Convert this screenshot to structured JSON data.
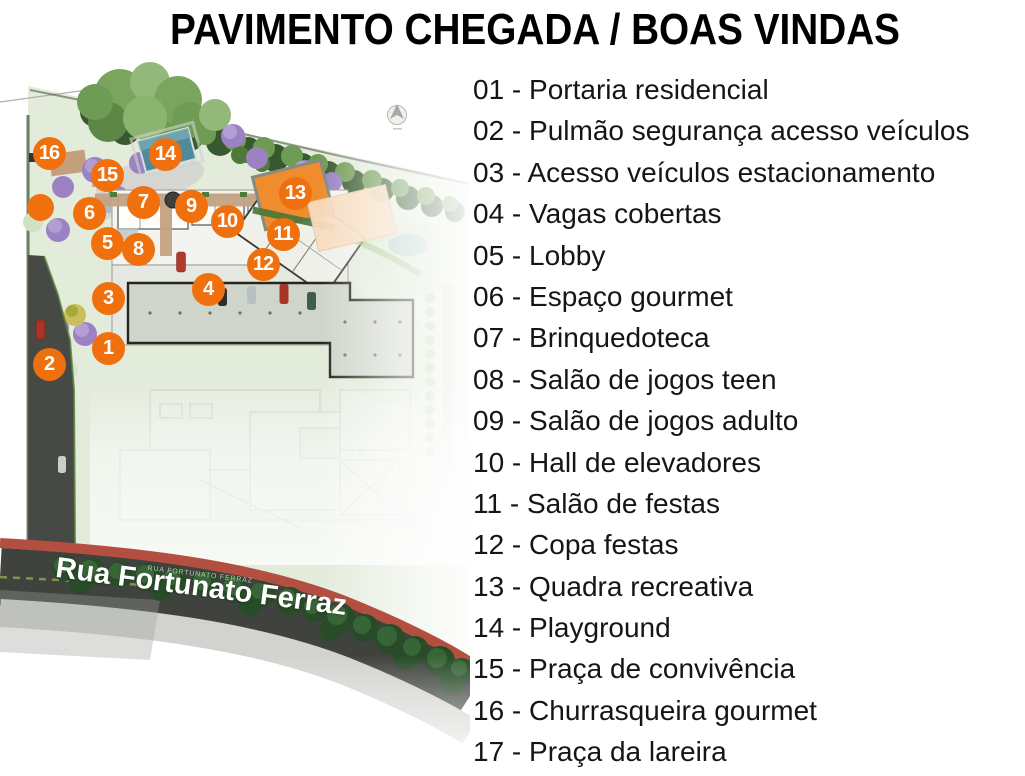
{
  "title": "PAVIMENTO CHEGADA / BOAS VINDAS",
  "legend": {
    "separator": " - ",
    "items": [
      {
        "num": "01",
        "label": "Portaria residencial"
      },
      {
        "num": "02",
        "label": "Pulmão segurança acesso veículos"
      },
      {
        "num": "03",
        "label": "Acesso veículos estacionamento"
      },
      {
        "num": "04",
        "label": "Vagas cobertas"
      },
      {
        "num": "05",
        "label": "Lobby"
      },
      {
        "num": "06",
        "label": "Espaço gourmet"
      },
      {
        "num": "07",
        "label": "Brinquedoteca"
      },
      {
        "num": "08",
        "label": "Salão de jogos teen"
      },
      {
        "num": "09",
        "label": "Salão de jogos adulto"
      },
      {
        "num": "10",
        "label": "Hall de elevadores"
      },
      {
        "num": "11",
        "label": "Salão de festas"
      },
      {
        "num": "12",
        "label": "Copa festas"
      },
      {
        "num": "13",
        "label": "Quadra recreativa"
      },
      {
        "num": "14",
        "label": "Playground"
      },
      {
        "num": "15",
        "label": "Praça de convivência"
      },
      {
        "num": "16",
        "label": "Churrasqueira gourmet"
      },
      {
        "num": "17",
        "label": "Praça da lareira"
      }
    ]
  },
  "map": {
    "street_label": "Rua Fortunato Ferraz",
    "street_label_small": "RUA FORTUNATO FERRAZ",
    "markers": [
      {
        "n": "16",
        "x": 49,
        "y": 93
      },
      {
        "n": "15",
        "x": 107,
        "y": 115
      },
      {
        "n": "14",
        "x": 165,
        "y": 94
      },
      {
        "n": "13",
        "x": 295,
        "y": 133
      },
      {
        "n": "7",
        "x": 143,
        "y": 142
      },
      {
        "n": "9",
        "x": 191,
        "y": 146
      },
      {
        "n": "6",
        "x": 89,
        "y": 153
      },
      {
        "n": "10",
        "x": 227,
        "y": 161
      },
      {
        "n": "11",
        "x": 283,
        "y": 174
      },
      {
        "n": "5",
        "x": 107,
        "y": 183
      },
      {
        "n": "8",
        "x": 138,
        "y": 189
      },
      {
        "n": "12",
        "x": 263,
        "y": 204
      },
      {
        "n": "4",
        "x": 208,
        "y": 229
      },
      {
        "n": "3",
        "x": 108,
        "y": 238
      },
      {
        "n": "1",
        "x": 108,
        "y": 288
      },
      {
        "n": "2",
        "x": 49,
        "y": 304
      },
      {
        "n": "",
        "x": 40,
        "y": 147
      }
    ],
    "colors": {
      "marker": "#f1700e",
      "court": "#ef8c2d",
      "court_deck": "#f8dcc0",
      "asphalt": "#3f423d",
      "red_lane": "#b24f41",
      "pool": "#4f8b9b"
    }
  }
}
